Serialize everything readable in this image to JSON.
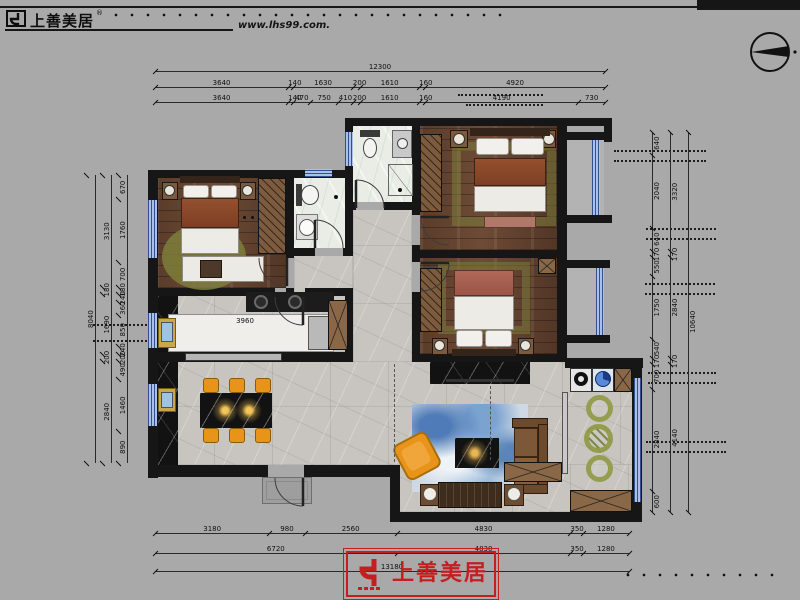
{
  "header": {
    "logo_text": "上善美居",
    "logo_sup": "®",
    "website": "www.lhs99.com."
  },
  "footer": {
    "logo_text": "上善美居"
  },
  "dimensions": {
    "top": {
      "total": [
        "12300"
      ],
      "row2": [
        "3640",
        "140",
        "1630",
        "200",
        "1610",
        "160",
        "4920"
      ],
      "row3": [
        "3640",
        "140",
        "470",
        "750",
        "410",
        "200",
        "1610",
        "160",
        "4190",
        "730"
      ]
    },
    "bottom": {
      "row1": [
        "3180",
        "980",
        "2560",
        "4830",
        "350",
        "1280"
      ],
      "row2": [
        "6720",
        "4830",
        "350",
        "1280"
      ],
      "total": [
        "13180"
      ]
    },
    "left": {
      "outer": [
        "8040"
      ],
      "mid": [
        "3130",
        "180",
        "1690",
        "200",
        "2840"
      ],
      "inner": [
        "670",
        "1760",
        "700",
        "180",
        "240",
        "360",
        "850",
        "240",
        "200",
        "490",
        "1460",
        "890"
      ]
    },
    "right": {
      "outer": [
        "10640"
      ],
      "mid": [
        "3320",
        "170",
        "2840",
        "170",
        "4140"
      ],
      "inner": [
        "640",
        "2040",
        "640",
        "170",
        "550",
        "1750",
        "540",
        "170",
        "700",
        "2840",
        "600"
      ]
    },
    "kitchen_island_width": "3960",
    "kitchen_island_depth": "1340"
  },
  "palette": {
    "background": "#a9a9a9",
    "wall": "#161616",
    "wood_floor": "#5f402d",
    "marble_floor": "#c8c5c0",
    "window_blue": "#7f9ed6",
    "chair_orange": "#e8941a",
    "rug_olive": "#82843e",
    "rug_blue": "#9db8d8",
    "sofa_brown": "#74512f",
    "logo_red": "#c41f1f"
  }
}
